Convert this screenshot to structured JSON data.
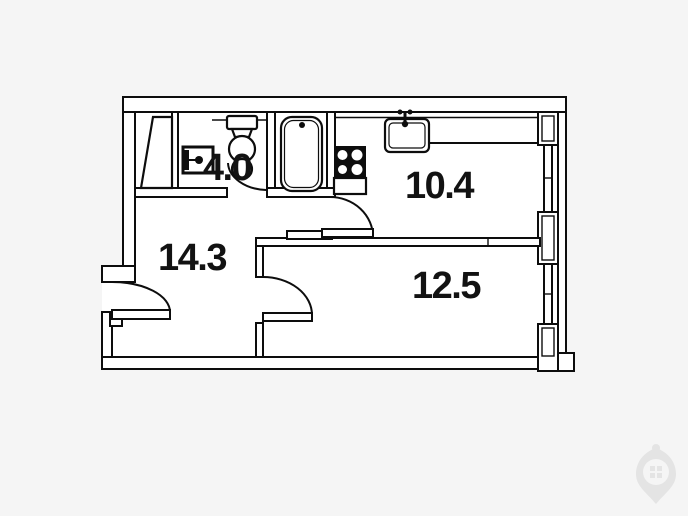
{
  "floor_plan": {
    "type": "apartment-floor-plan",
    "rooms": [
      {
        "name": "wc-bathroom",
        "area": "4.0"
      },
      {
        "name": "kitchen",
        "area": "10.4"
      },
      {
        "name": "hallway",
        "area": "14.3"
      },
      {
        "name": "living-room",
        "area": "12.5"
      }
    ],
    "fixtures": [
      "wardrobe-icon",
      "washbasin-icon",
      "toilet-icon",
      "bathtub-icon",
      "stove-icon",
      "kitchen-sink-icon",
      "entrance-door",
      "wc-door",
      "kitchen-door",
      "room-door",
      "window-kitchen",
      "window-room"
    ],
    "colors": {
      "background": "#f5f5f5",
      "floor": "#ffffff",
      "line": "#0d0d0d",
      "watermark": "#e4e4e4"
    }
  },
  "watermark": {
    "name": "developer-logo"
  }
}
